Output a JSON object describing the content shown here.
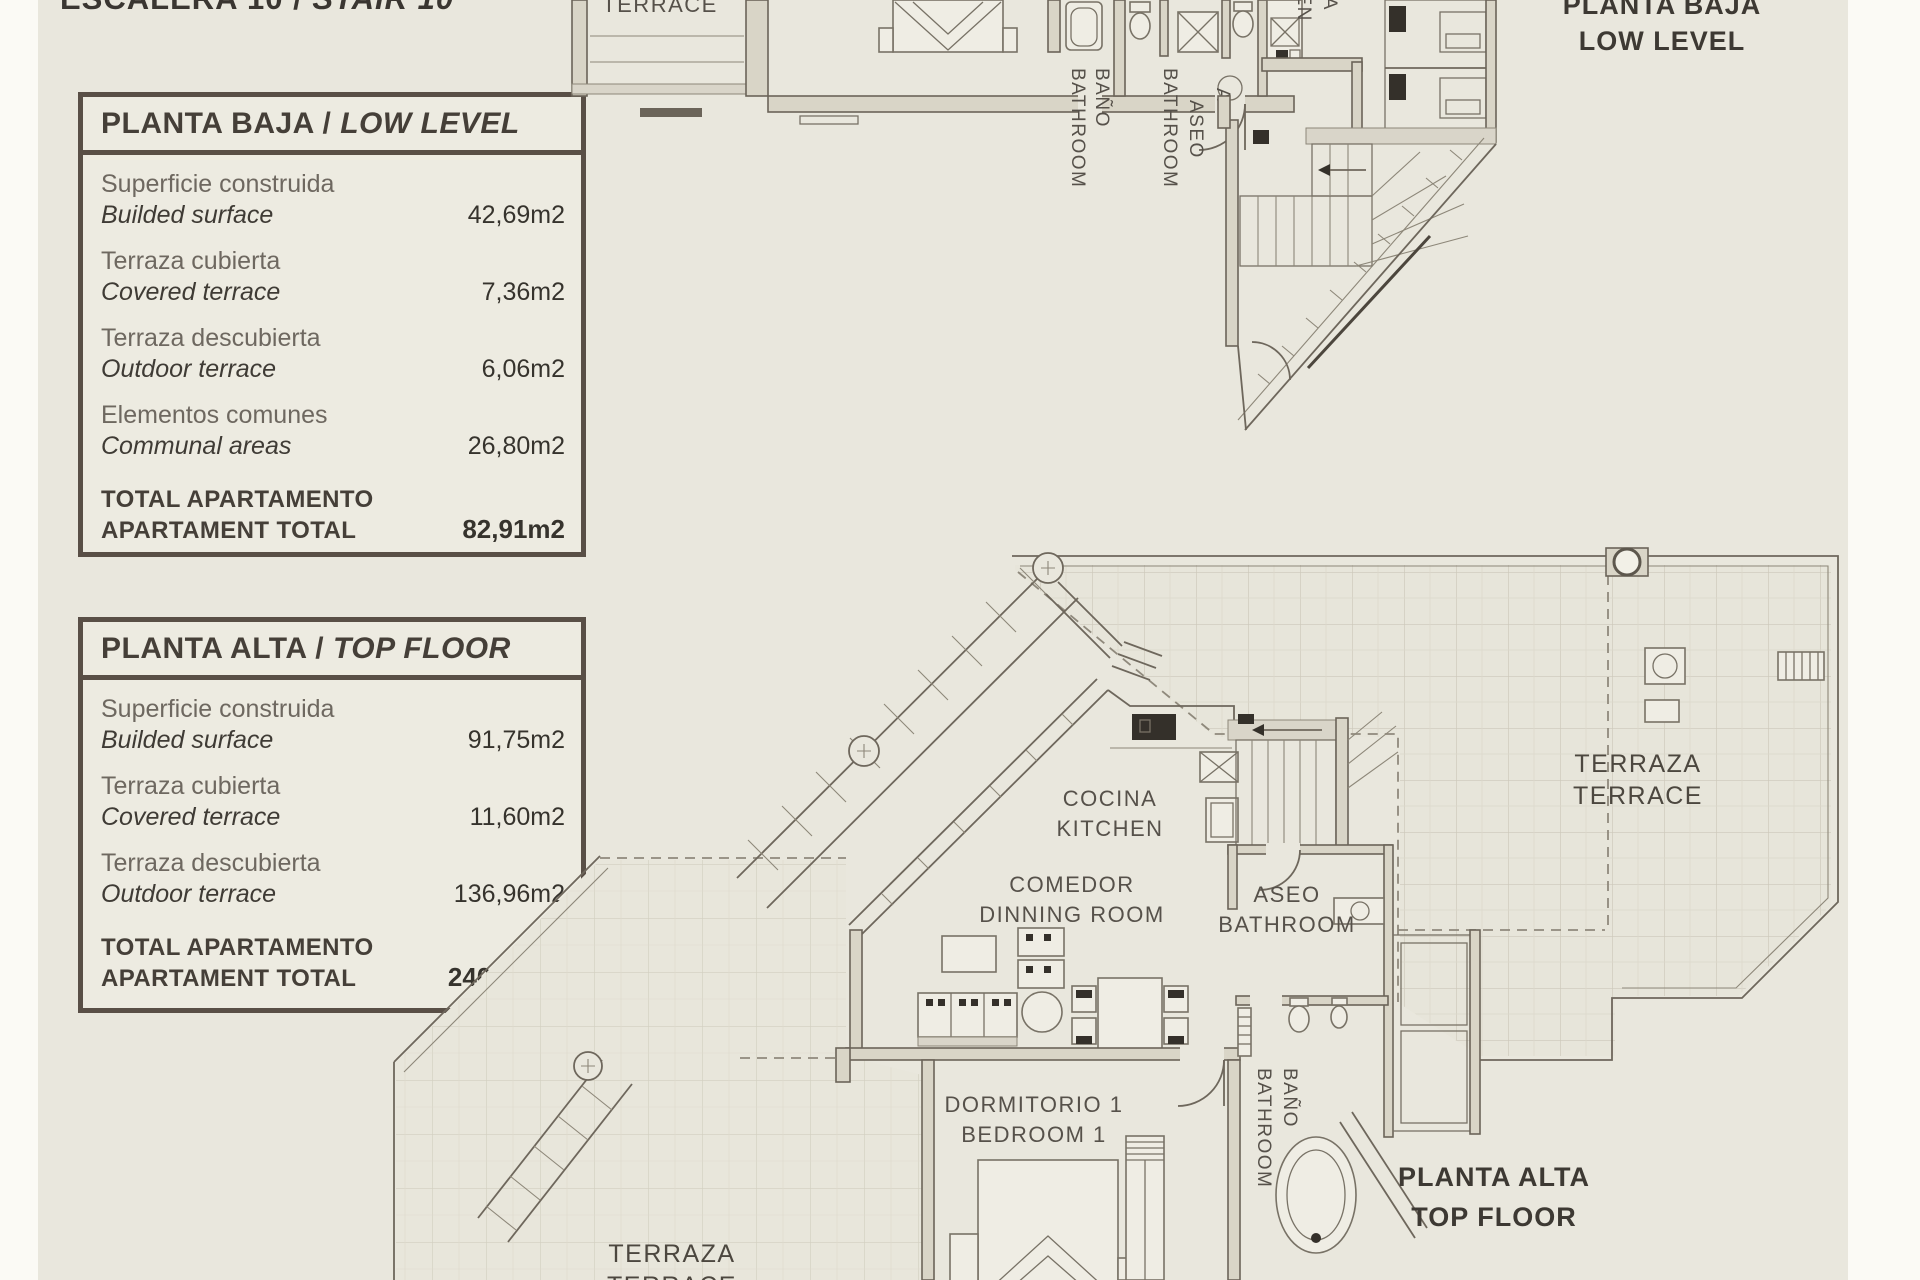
{
  "sheet_title": {
    "part_es": "ESCALERA 10 /",
    "part_en": "STAIR 10"
  },
  "tables": [
    {
      "title_es": "PLANTA BAJA",
      "title_sep": " / ",
      "title_en": "LOW LEVEL",
      "rows": [
        {
          "es": "Superficie construida",
          "en": "Builded surface",
          "value": "42,69m2"
        },
        {
          "es": "Terraza cubierta",
          "en": "Covered terrace",
          "value": "7,36m2"
        },
        {
          "es": "Terraza descubierta",
          "en": "Outdoor terrace",
          "value": "6,06m2"
        },
        {
          "es": "Elementos comunes",
          "en": "Communal areas",
          "value": "26,80m2"
        }
      ],
      "total": {
        "es": "TOTAL APARTAMENTO",
        "en": "APARTAMENT TOTAL",
        "value": "82,91m2"
      }
    },
    {
      "title_es": "PLANTA ALTA",
      "title_sep": " / ",
      "title_en": "TOP FLOOR",
      "rows": [
        {
          "es": "Superficie construida",
          "en": "Builded surface",
          "value": "91,75m2"
        },
        {
          "es": "Terraza cubierta",
          "en": "Covered terrace",
          "value": "11,60m2"
        },
        {
          "es": "Terraza descubierta",
          "en": "Outdoor terrace",
          "value": "136,96m2"
        }
      ],
      "total": {
        "es": "TOTAL APARTAMENTO",
        "en": "APARTAMENT TOTAL",
        "value": "240,31m2"
      }
    }
  ],
  "plans": {
    "low": {
      "floor1": "PLANTA BAJA",
      "floor2": "LOW LEVEL",
      "terrace": "TERRACE",
      "bano1": "BAÑO",
      "bano2": "BATHROOM",
      "aseo1": "ASEO",
      "aseo2": "BATHROOM",
      "cocina1": "COCINA",
      "cocina2": "KITCHEN",
      "door_mark": "A"
    },
    "top": {
      "floor1": "PLANTA ALTA",
      "floor2": "TOP FLOOR",
      "terr_right1": "TERRAZA",
      "terr_right2": "TERRACE",
      "cocina1": "COCINA",
      "cocina2": "KITCHEN",
      "comedor1": "COMEDOR",
      "comedor2": "DINNING ROOM",
      "aseo1": "ASEO",
      "aseo2": "BATHROOM",
      "dorm1": "DORMITORIO 1",
      "dorm2": "BEDROOM 1",
      "bano1": "BAÑO",
      "bano2": "BATHROOM",
      "terr_bottom1": "TERRAZA",
      "terr_bottom2": "TERRACE"
    }
  },
  "colors": {
    "accent_border": "#594f46",
    "background": "#e9e7dd",
    "wall": "#6b6459"
  }
}
